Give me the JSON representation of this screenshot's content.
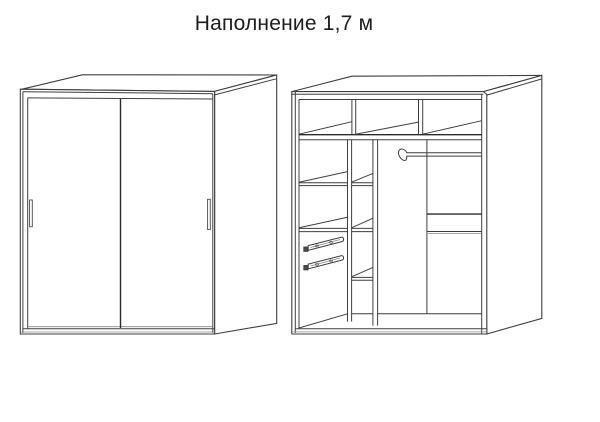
{
  "title": "Наполнение 1,7 м",
  "colors": {
    "background": "#ffffff",
    "line": "#3f3f3f",
    "line_dark": "#2b2b2b",
    "line_light": "#8a8a8a",
    "text": "#1c1c1c"
  }
}
